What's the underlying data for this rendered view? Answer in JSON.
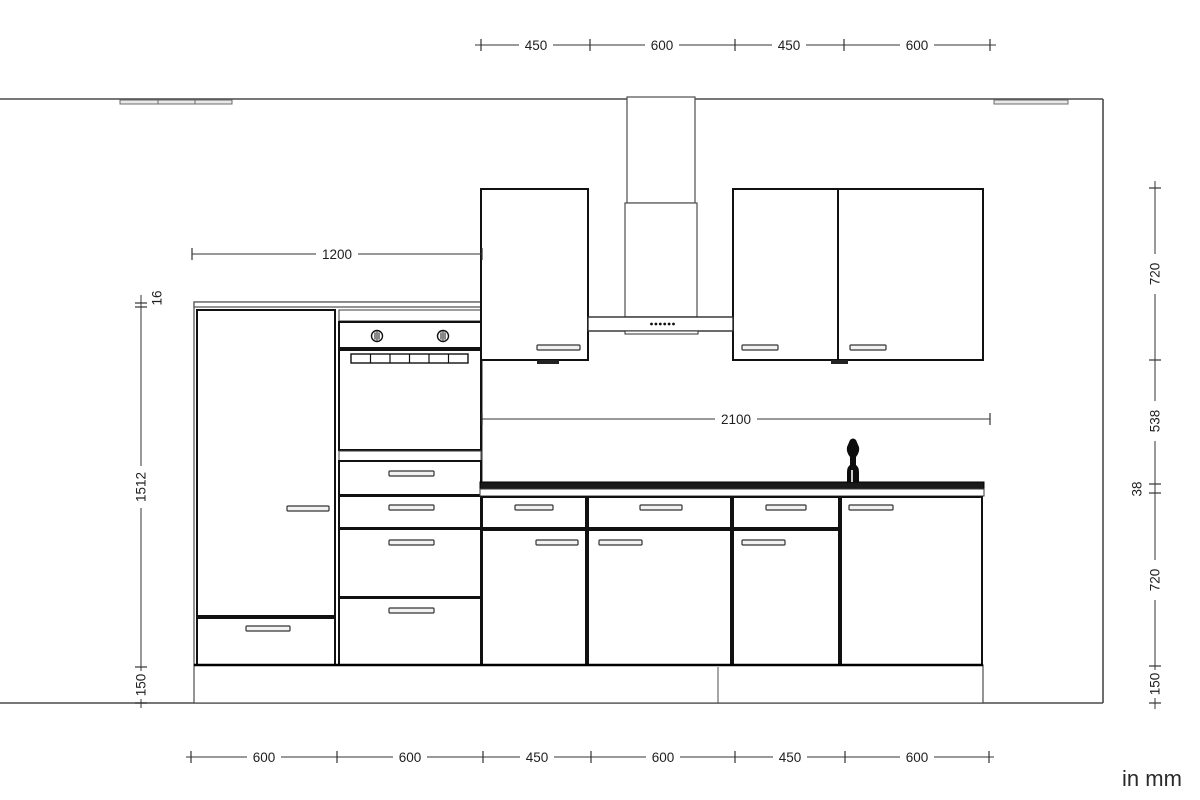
{
  "title": "kitchen-elevation-drawing",
  "units_note": "in mm",
  "dims": {
    "top": [
      "450",
      "600",
      "450",
      "600"
    ],
    "middle_upper": "1200",
    "middle_lower": "2100",
    "left": [
      "16",
      "1512",
      "150"
    ],
    "right": [
      "720",
      "538",
      "38",
      "720",
      "150"
    ],
    "bottom": [
      "600",
      "600",
      "450",
      "600",
      "450",
      "600"
    ]
  },
  "colors": {
    "background": "#ffffff",
    "line": "#333333",
    "cabinet_front": "#111111",
    "countertop": "#1a1a1a",
    "label_text": "#1f1f1f"
  }
}
